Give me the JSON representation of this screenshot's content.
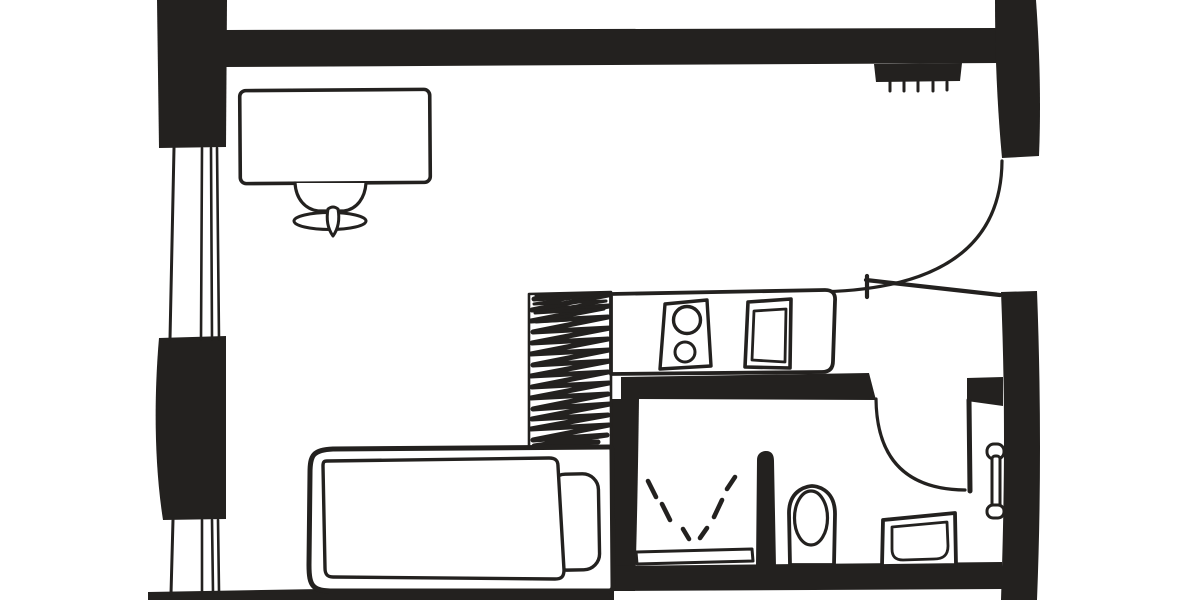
{
  "colors": {
    "ink": "#23211f",
    "paper": "#ffffff"
  },
  "plan": {
    "type": "floor-plan",
    "drawing_style": "hand-drawn black ink, top-down view of a studio apartment",
    "rooms": [
      {
        "name": "main-room",
        "features": [
          "window-upper",
          "window-lower",
          "desk",
          "desk-chair",
          "hatched-cabinet",
          "bed",
          "pillow",
          "mattress"
        ]
      },
      {
        "name": "kitchen-nook",
        "features": [
          "kitchen-counter",
          "stove-two-burner",
          "kitchen-sink"
        ]
      },
      {
        "name": "entry",
        "features": [
          "entrance-door",
          "radiator"
        ]
      },
      {
        "name": "bathroom",
        "features": [
          "bathroom-door",
          "shower-spray",
          "shower-tray",
          "shower-partition",
          "toilet",
          "washbasin",
          "towel-rail"
        ]
      }
    ],
    "openings": [
      {
        "name": "entrance-door",
        "type": "door",
        "wall": "right",
        "swing": "inward"
      },
      {
        "name": "bathroom-door",
        "type": "door",
        "wall": "bathroom-top",
        "swing": "into-bathroom"
      },
      {
        "name": "window-upper",
        "type": "window",
        "wall": "left"
      },
      {
        "name": "window-lower",
        "type": "window",
        "wall": "left"
      }
    ]
  }
}
